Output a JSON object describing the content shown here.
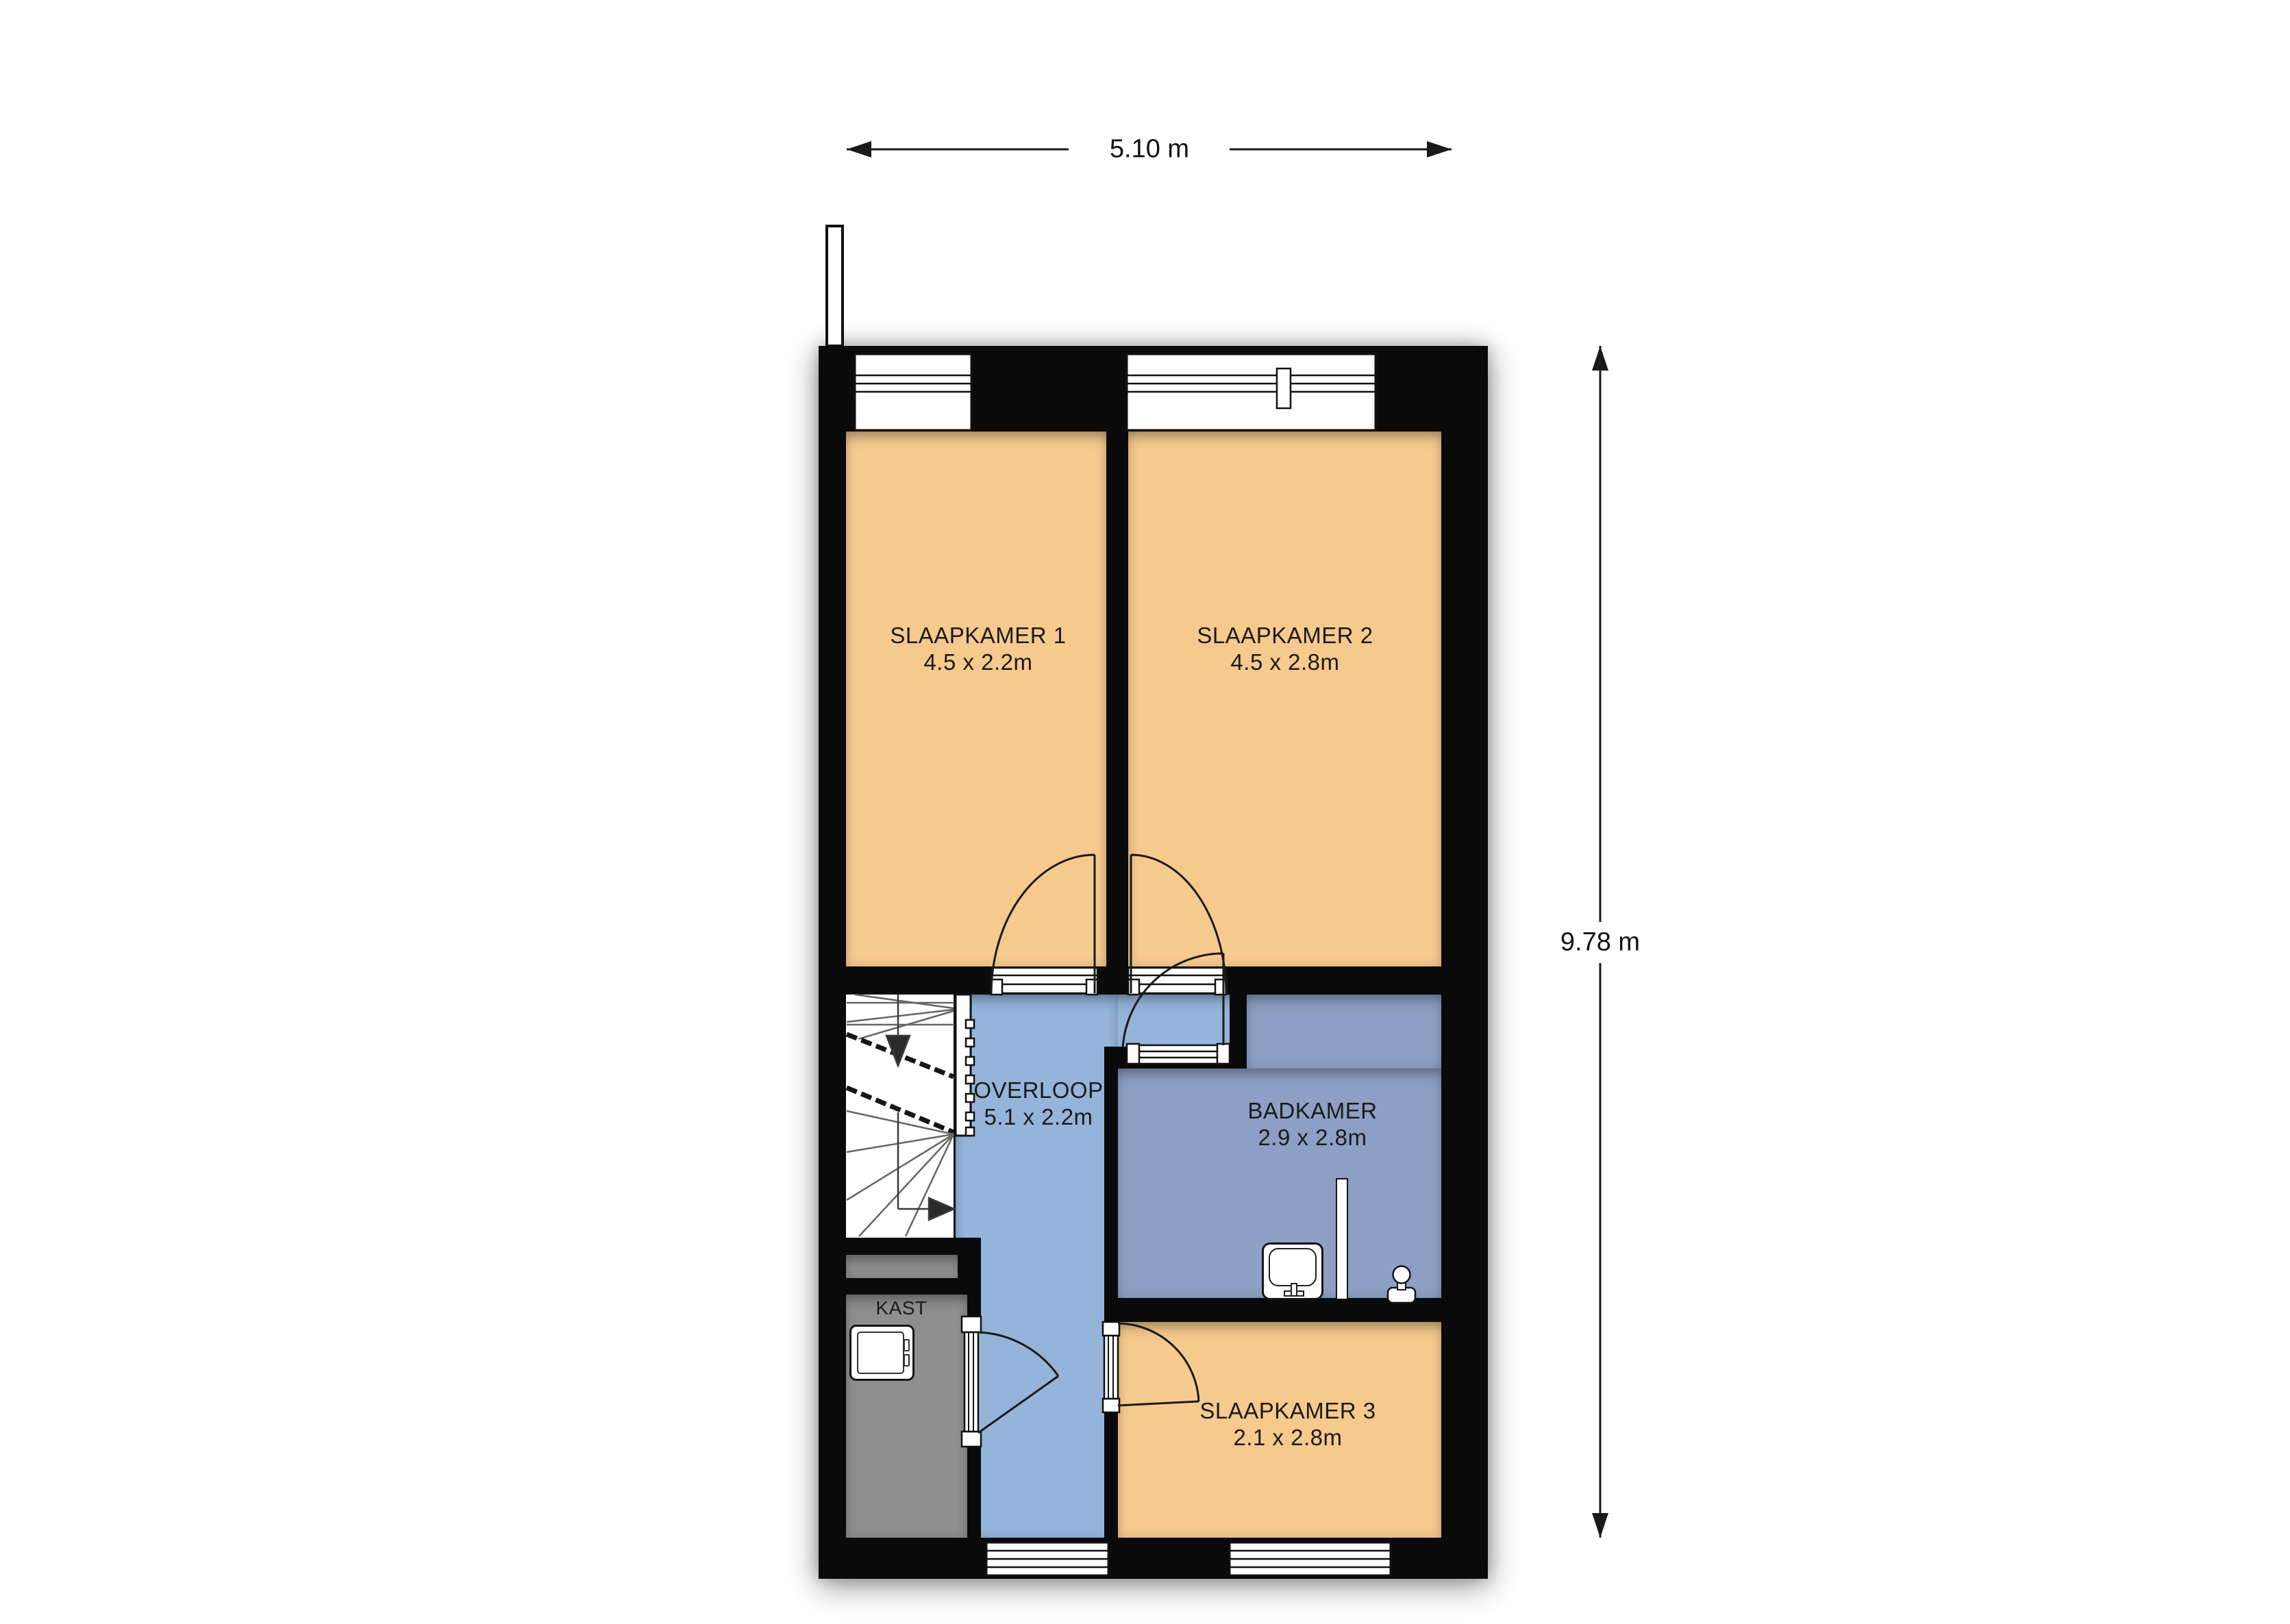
{
  "dimensions": {
    "width_label": "5.10 m",
    "height_label": "9.78 m"
  },
  "rooms": [
    {
      "name": "SLAAPKAMER 1",
      "size": "4.5 x 2.2m",
      "type": "bedroom"
    },
    {
      "name": "SLAAPKAMER 2",
      "size": "4.5 x 2.8m",
      "type": "bedroom"
    },
    {
      "name": "BADKAMER",
      "size": "2.9 x 2.8m",
      "type": "bathroom"
    },
    {
      "name": "OVERLOOP",
      "size": "5.1 x 2.2m",
      "type": "hallway"
    },
    {
      "name": "KAST",
      "size": "",
      "type": "closet"
    },
    {
      "name": "SLAAPKAMER 3",
      "size": "2.1 x 2.8m",
      "type": "bedroom"
    }
  ],
  "fixtures": [
    {
      "name": "staircase-down"
    },
    {
      "name": "washing-machine"
    },
    {
      "name": "washbasin"
    },
    {
      "name": "shower-screen"
    },
    {
      "name": "toilet"
    },
    {
      "name": "hinged-door",
      "count": 5
    },
    {
      "name": "window",
      "count": 4
    }
  ],
  "colors": {
    "bedroom": "#f6c98d",
    "hallway": "#94b4da",
    "bathroom": "#8d9fc4",
    "closet": "#8f8f8f",
    "wall": "#0a0a0a",
    "line": "#1a1a1a",
    "background": "#ffffff"
  }
}
